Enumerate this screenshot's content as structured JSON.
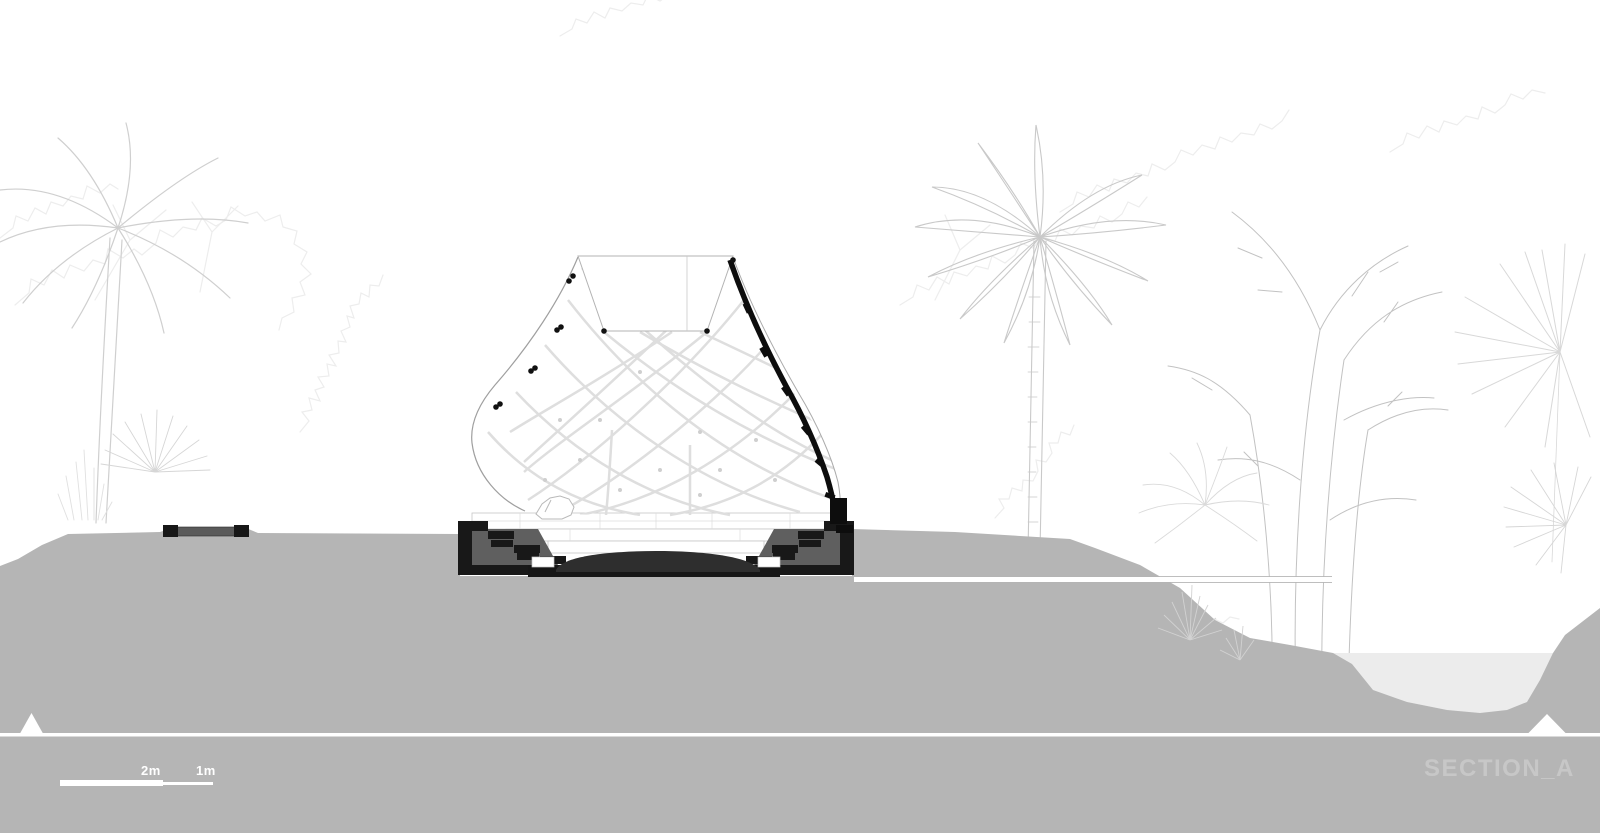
{
  "drawing": {
    "section_label": "SECTION_A"
  },
  "scale_bar": {
    "major_label": "2m",
    "minor_label": "1m"
  },
  "colors": {
    "ground": "#b5b5b5",
    "water": "#ececec",
    "pit_gray": "#5f5f5f",
    "cut_black": "#161616",
    "lens": "#2e2e2e",
    "lattice": "#dedede",
    "shell_outline": "#9f9f9f",
    "vegetation_light": "#ededed",
    "vegetation_mid": "#cfcfcf",
    "label_text": "#c7c7c7",
    "scale_text": "#ffffff"
  },
  "icons": {
    "left_marker": "section-cut-triangle",
    "right_marker": "section-cut-triangle"
  }
}
